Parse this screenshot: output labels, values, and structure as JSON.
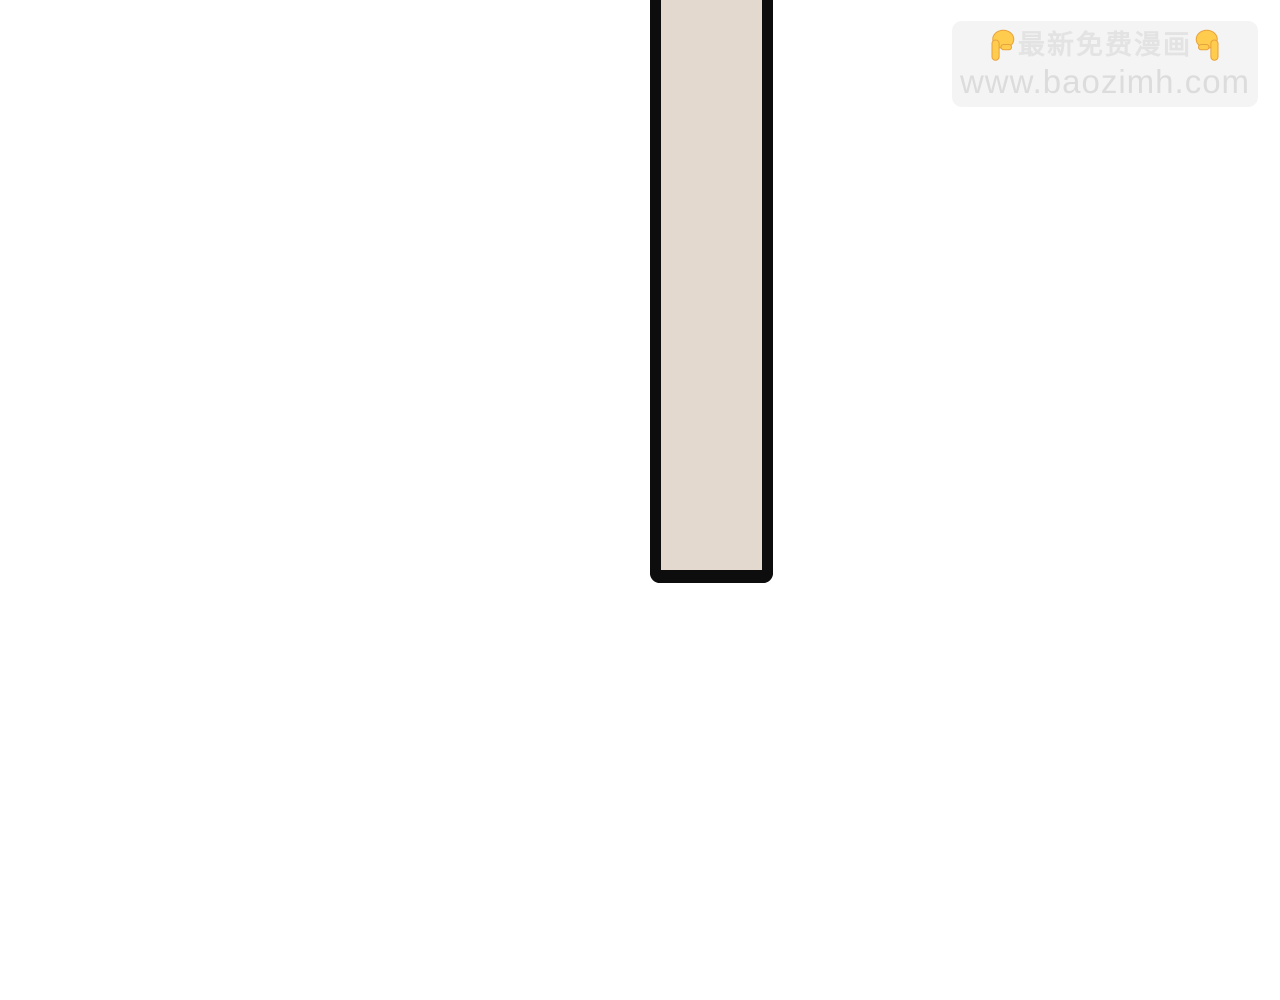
{
  "page": {
    "background": "#ffffff"
  },
  "panel": {
    "fill": "#e3d9ce",
    "border_color": "#0d0d0d"
  },
  "watermark": {
    "line1": "最新免费漫画",
    "line2": "www.baozimh.com",
    "left_icon": "point-down-emoji",
    "right_icon": "point-down-emoji",
    "background": "#f4f4f4",
    "text_color_line1": "#e3e3e3",
    "text_color_line2": "#dcdcdc",
    "emoji_color": "#ffcc4d"
  }
}
